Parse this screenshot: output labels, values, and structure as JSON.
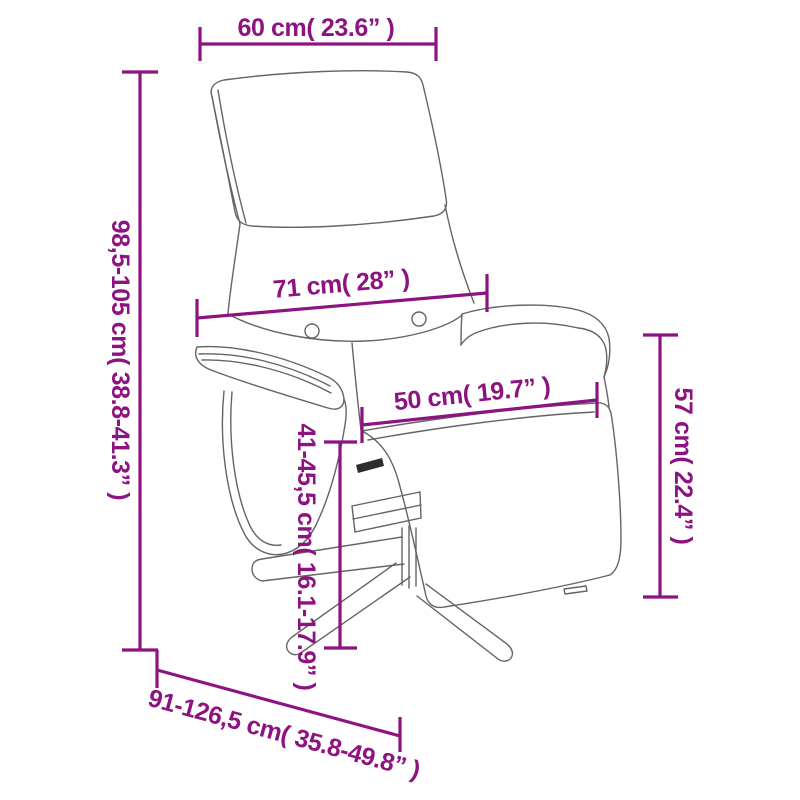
{
  "colors": {
    "dimension_accent": "#8D1380",
    "chair_line": "#646464",
    "background": "#FFFFFF"
  },
  "dimensions": {
    "headrest_width": {
      "label": "60 cm( 23.6” )"
    },
    "overall_height": {
      "label": "98,5-105 cm( 38.8-41.3” )"
    },
    "backrest_width": {
      "label": "71 cm( 28” )"
    },
    "seat_width": {
      "label": "50 cm( 19.7” )"
    },
    "armrest_height": {
      "label": "57 cm( 22.4” )"
    },
    "seat_height": {
      "label": "41-45,5 cm( 16.1-17.9” )"
    },
    "overall_depth": {
      "label": "91-126,5 cm( 35.8-49.8” )"
    }
  }
}
